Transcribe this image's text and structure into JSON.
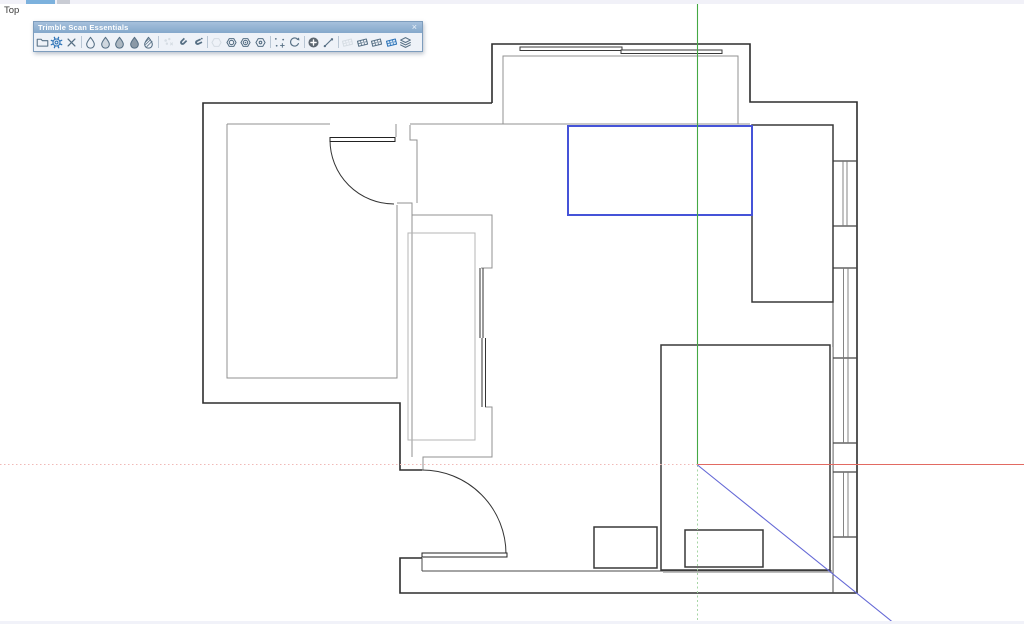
{
  "viewport": {
    "label": "Top"
  },
  "toolbar": {
    "title": "Trimble Scan Essentials",
    "close_glyph": "×",
    "icons": [
      {
        "name": "open-file-icon",
        "glyph": "folder",
        "state": "default"
      },
      {
        "name": "settings-gear-icon",
        "glyph": "gear",
        "state": "highlighted"
      },
      {
        "name": "clear-icon",
        "glyph": "clear",
        "state": "default"
      },
      {
        "name": "separator"
      },
      {
        "name": "point-cloud-outline-icon",
        "glyph": "drop0",
        "state": "default"
      },
      {
        "name": "point-cloud-half-icon",
        "glyph": "drop1",
        "state": "default"
      },
      {
        "name": "point-cloud-shaded-icon",
        "glyph": "drop2",
        "state": "default"
      },
      {
        "name": "point-cloud-solid-icon",
        "glyph": "drop3",
        "state": "default"
      },
      {
        "name": "point-cloud-hatched-icon",
        "glyph": "drop4",
        "state": "default"
      },
      {
        "name": "separator"
      },
      {
        "name": "sample-points-icon",
        "glyph": "sparkle",
        "state": "disabled"
      },
      {
        "name": "magnet-icon",
        "glyph": "magnet",
        "state": "default"
      },
      {
        "name": "magnet-alt-icon",
        "glyph": "magnet2",
        "state": "default"
      },
      {
        "name": "separator"
      },
      {
        "name": "hexagon-outline-icon",
        "glyph": "hex0",
        "state": "disabled"
      },
      {
        "name": "hexagon-circle-icon",
        "glyph": "hex1",
        "state": "default"
      },
      {
        "name": "hexagon-target-icon",
        "glyph": "hex2",
        "state": "default"
      },
      {
        "name": "hexagon-ring-icon",
        "glyph": "hex3",
        "state": "default"
      },
      {
        "name": "separator"
      },
      {
        "name": "scatter-points-icon",
        "glyph": "scatter",
        "state": "default"
      },
      {
        "name": "rotate-icon",
        "glyph": "rotate",
        "state": "default"
      },
      {
        "name": "separator"
      },
      {
        "name": "add-point-icon",
        "glyph": "plus",
        "state": "default"
      },
      {
        "name": "measure-line-icon",
        "glyph": "pen",
        "state": "default"
      },
      {
        "name": "separator"
      },
      {
        "name": "mesh-faint-icon",
        "glyph": "mesh",
        "state": "disabled"
      },
      {
        "name": "mesh-icon",
        "glyph": "mesh",
        "state": "default"
      },
      {
        "name": "mesh-dense-icon",
        "glyph": "mesh",
        "state": "default"
      },
      {
        "name": "mesh-active-icon",
        "glyph": "meshblue",
        "state": "highlighted"
      },
      {
        "name": "layers-icon",
        "glyph": "layers",
        "state": "default"
      }
    ]
  },
  "axes": {
    "green_solid": "#44a944",
    "green_dotted": "#a6d6a4",
    "red_solid": "#e26a62",
    "red_dotted": "#f1b9b7",
    "blue_solid": "#6468d6"
  },
  "selection": {
    "color": "#4553d8"
  }
}
